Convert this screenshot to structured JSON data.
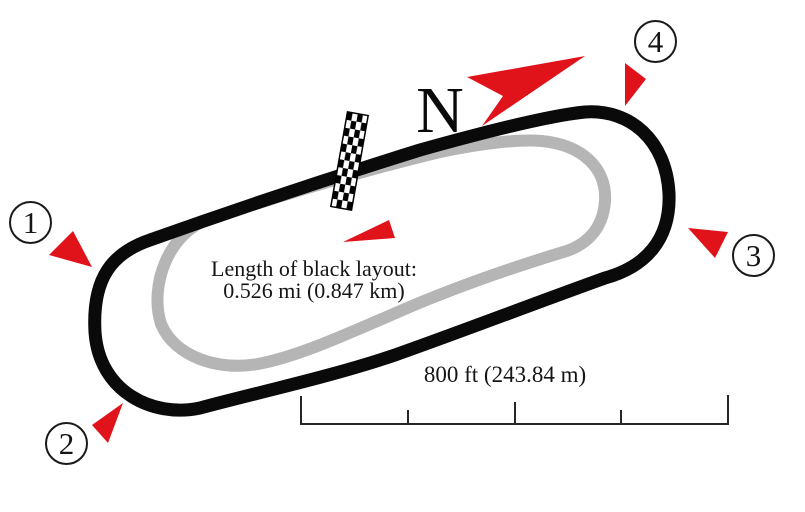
{
  "diagram": {
    "type": "race-track-layout-map",
    "north_label": "N",
    "length_note": {
      "line1": "Length of black layout:",
      "line2": "0.526 mi (0.847 km)"
    },
    "scale_bar": {
      "label": "800 ft (243.84 m)"
    },
    "turn_markers": [
      {
        "label": "1"
      },
      {
        "label": "2"
      },
      {
        "label": "3"
      },
      {
        "label": "4"
      }
    ]
  },
  "colors": {
    "accent_red": "#e0131a",
    "track_black": "#0a0a0a",
    "track_gray": "#b5b5b5",
    "ink": "#151515"
  }
}
